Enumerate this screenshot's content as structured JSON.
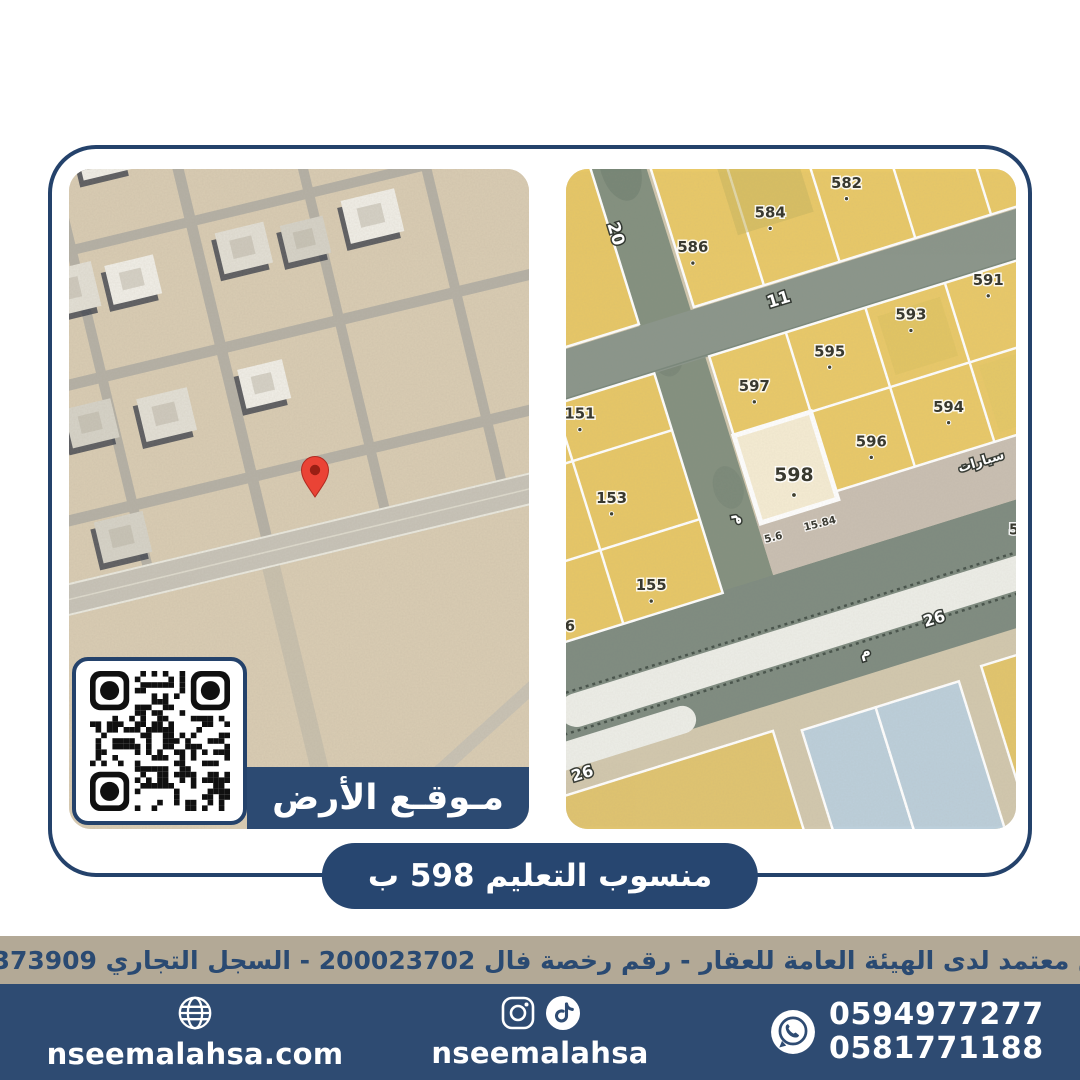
{
  "colors": {
    "navy": "#2c4a72",
    "navy_dark": "#24426b",
    "footer_navy": "#2e4b72",
    "beige": "#b3a996",
    "parcel_yellow": "#e9c968",
    "parcel_blue": "#bccfdb",
    "highlight_parcel": "#f5ecd3",
    "road_green": "#83907f",
    "pin_red": "#ea4335"
  },
  "card": {
    "location_banner": "مـوقـع الأرض"
  },
  "parcel_map": {
    "parcels": {
      "p151": "151",
      "p153": "153",
      "p155": "155",
      "p582": "582",
      "p584": "584",
      "p586": "586",
      "p591": "591",
      "p593": "593",
      "p594": "594",
      "p595": "595",
      "p596": "596",
      "p597": "597",
      "p598": "598"
    },
    "partial_parcels": {
      "left": "6",
      "right": "5"
    },
    "streets": {
      "s20": "20",
      "s11": "11",
      "s26_upper": "26",
      "s26_lower": "26",
      "m_vertical": "م",
      "m_26": "م"
    },
    "dimensions": {
      "d1": "5.6",
      "d2": "15.84"
    },
    "area_label": "سيارات"
  },
  "ribbon": {
    "text": "منسوب التعليم 598 ب"
  },
  "license_bar": {
    "text": "مسوق معتمد لدى الهيئة العامة للعقار - رقم رخصة فال 200023702 - السجل التجاري 2250373909"
  },
  "footer": {
    "website": "nseemalahsa.com",
    "social_handle": "nseemalahsa",
    "phones": [
      "0594977277",
      "0581771188"
    ]
  }
}
